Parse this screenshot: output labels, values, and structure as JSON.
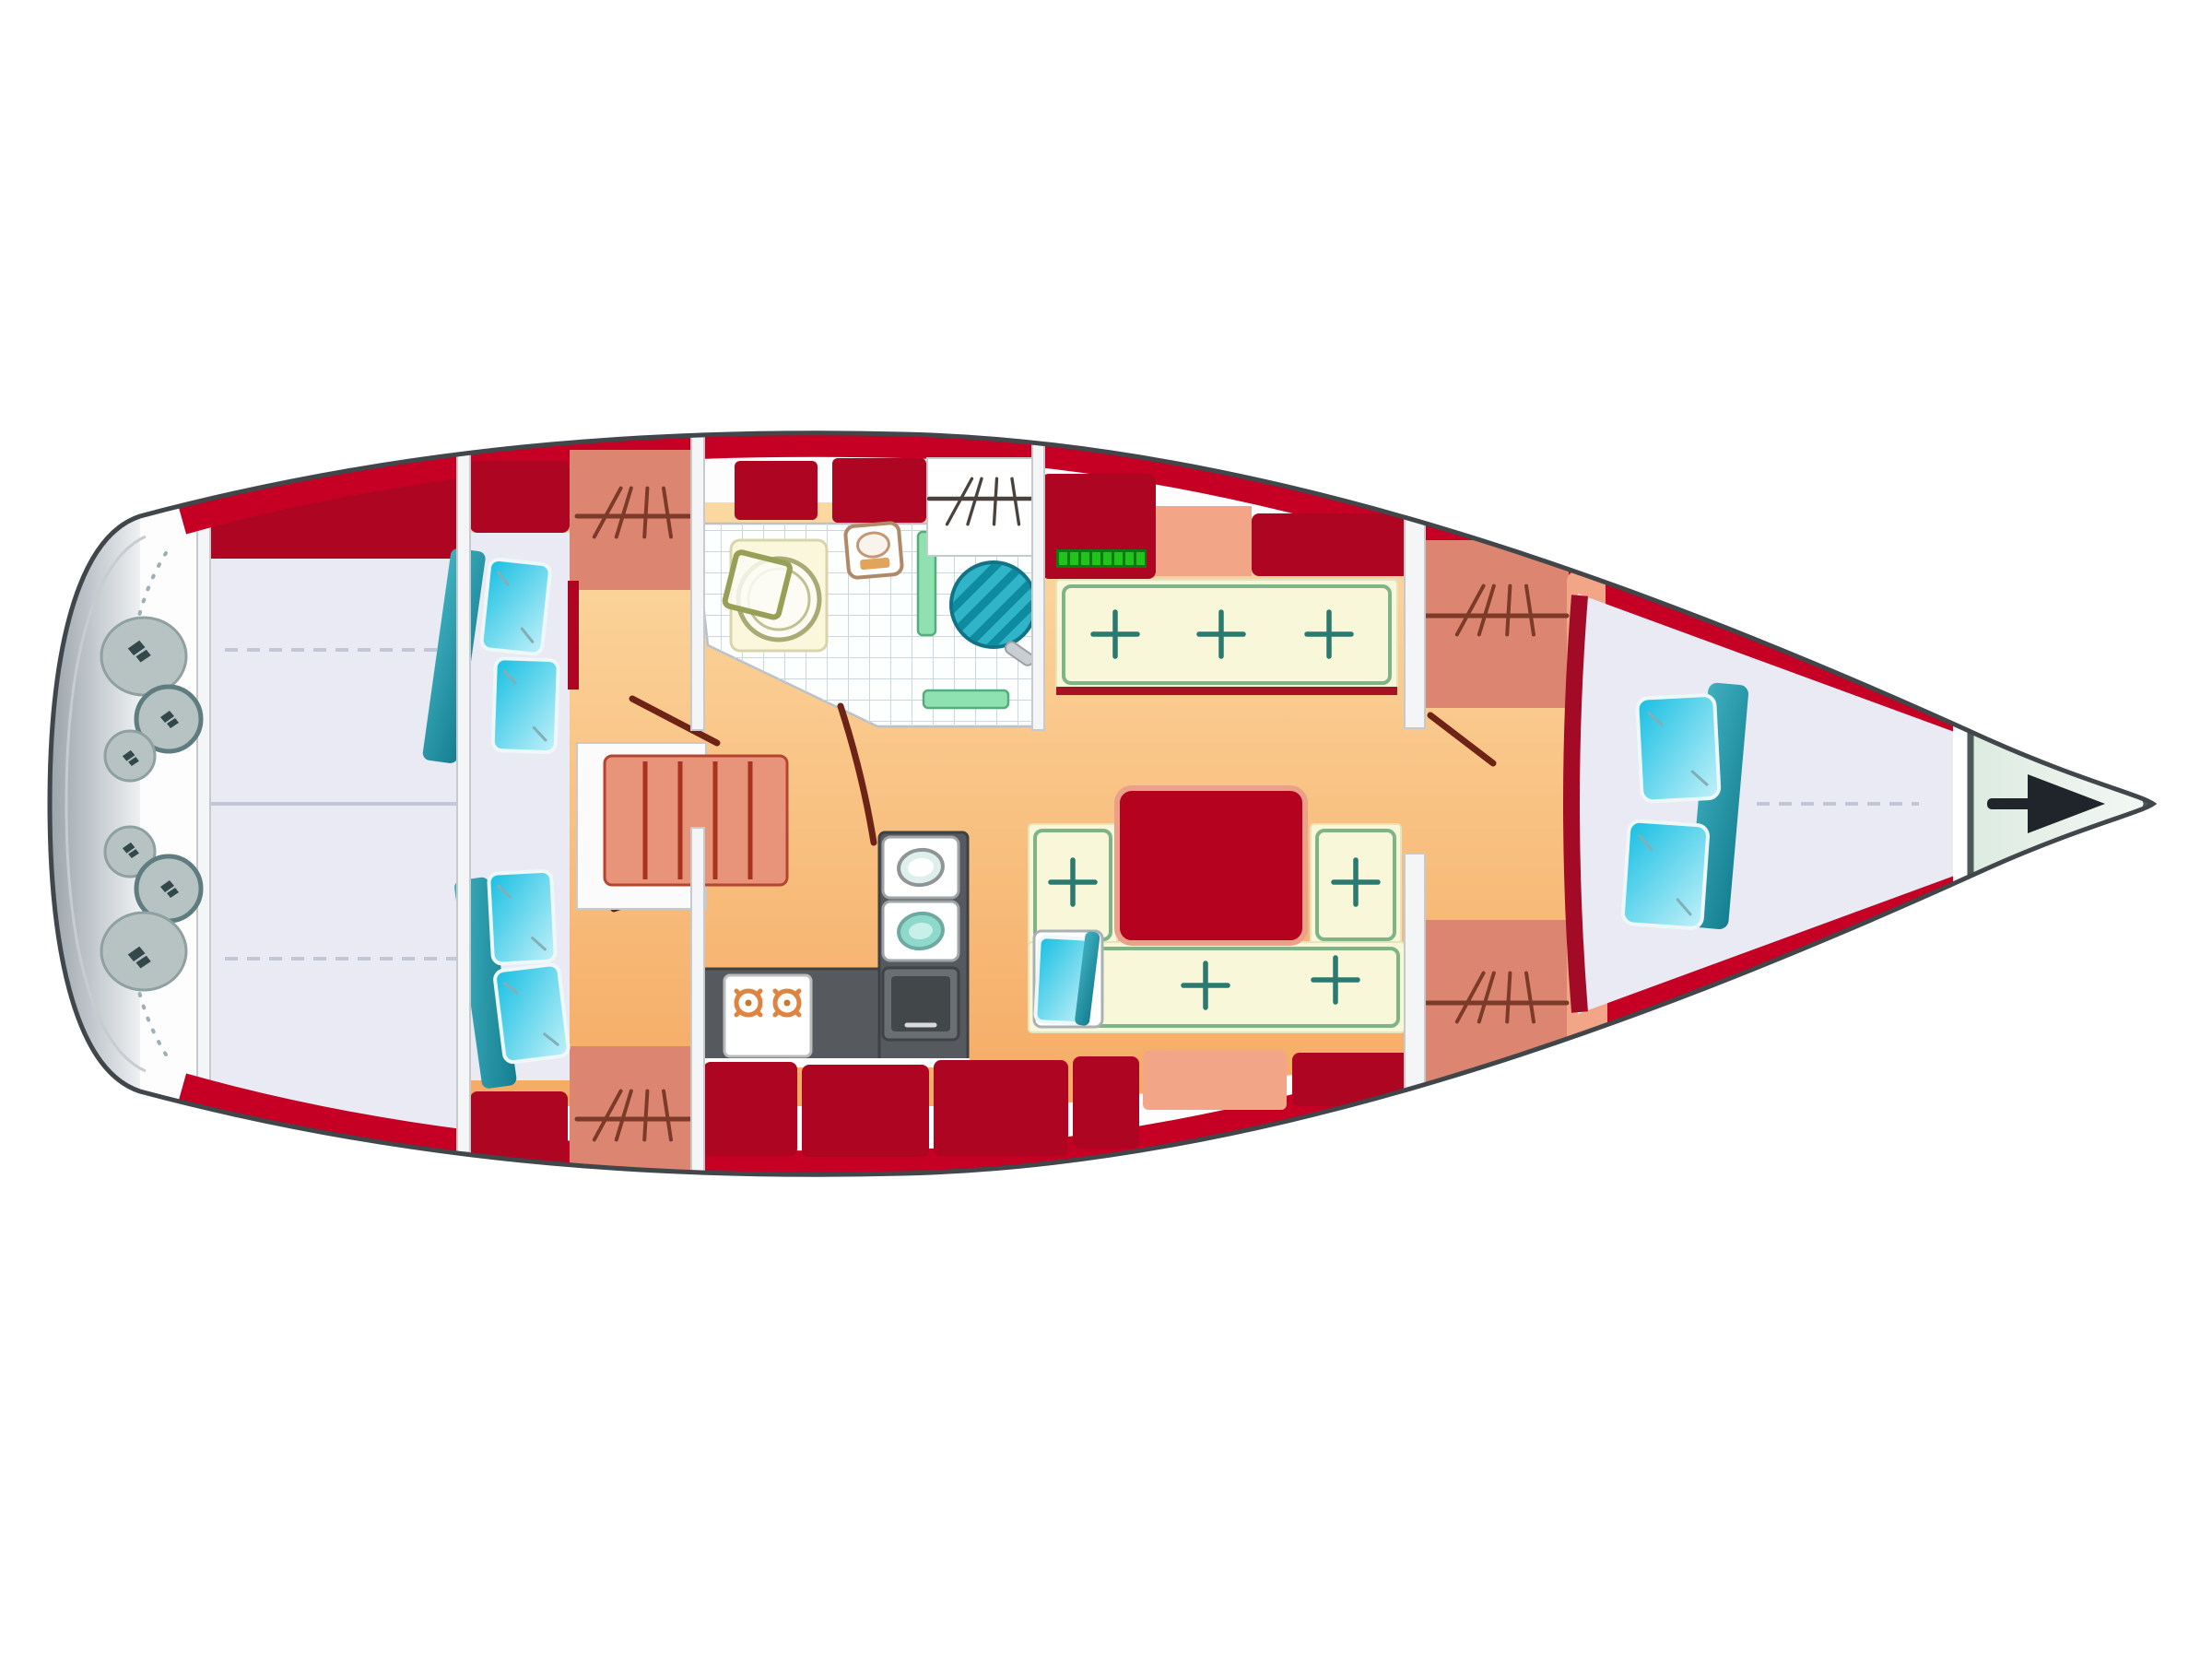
{
  "palette": {
    "hull_outline": "#40464a",
    "hull_fill": "#fdfdfe",
    "band_red": "#c50024",
    "block_red": "#ad0522",
    "table_red": "#b4021f",
    "table_edge": "#eba189",
    "berth_salmon": "#dc8671",
    "salmon_light": "#f2a687",
    "floor_light": "#fcd9a2",
    "floor_deep": "#f5ab64",
    "lavender": "#e9eaf4",
    "cream": "#f8f7d9",
    "cream_edge": "#e6e4bc",
    "settee_green": "#7fb489",
    "settee_lip": "#a51325",
    "tuft_teal": "#2a7a72",
    "cyan_light": "#c2f1f9",
    "cyan_deep": "#17bfe3",
    "blanket_teal": "#147e90",
    "blanket_teal_light": "#3fb0bf",
    "green_strip": "#8fe2b0",
    "green_strip_border": "#57ab7e",
    "bright_green": "#21c41d",
    "bright_green_dark": "#0b7a10",
    "galley_dark": "#565a5e",
    "galley_edge": "#3d4144",
    "burner_orange": "#df8440",
    "tile_line": "#ccd6de",
    "tile_fill": "#fdfefe",
    "platform_dark": "#9aa4ab",
    "platform_light": "#eef0f2",
    "winch_gray": "#b7c2c3",
    "winch_border": "#8fa0a1",
    "winch_ring": "#5f7d80",
    "winch_glyph": "#33484b",
    "anchor_dark": "#20252b",
    "bow_fill": "#dcebe1",
    "bow_fill_light": "#f3f8f4",
    "bow_outline": "#4b5a58",
    "door_line": "#6e2317",
    "hatch_line": "#7c3a28",
    "hatch_dark": "#4a423c",
    "wall_fill": "#f4f5f7",
    "wall_line": "#c6cacd",
    "shower_ring": "#a9aa74",
    "shower_panel": "#faf7dc",
    "shower_panel_edge": "#d9d5ab",
    "toilet_line": "#b08968",
    "toilet_seat": "#e2a35b",
    "basin_teal": "#2fb4c8",
    "basin_stripe": "#0f8ba0",
    "basin_edge": "#107486",
    "seam_line": "#c2c6d6",
    "white": "#ffffff",
    "steps_fill": "#e8947a",
    "steps_line": "#a83420",
    "steps_edge": "#b5452f"
  },
  "plan": {
    "type": "sailboat-interior-floor-plan",
    "orientation": {
      "bow": "right",
      "stern": "left"
    },
    "rooms": [
      {
        "name": "swim-platform",
        "fixtures": [
          "transom-rail"
        ]
      },
      {
        "name": "cockpit",
        "fixtures": [
          "steering-winches",
          "bench-seat",
          "centerline-seam"
        ],
        "winch_count": 6
      },
      {
        "name": "aft-cabin-port",
        "fixtures": [
          "double-berth",
          "pillows",
          "locker",
          "door"
        ],
        "pillow_count": 2
      },
      {
        "name": "aft-cabin-starboard",
        "fixtures": [
          "double-berth",
          "pillows",
          "locker",
          "door"
        ],
        "pillow_count": 2
      },
      {
        "name": "companionway",
        "fixtures": [
          "steps"
        ],
        "step_count": 5
      },
      {
        "name": "head",
        "fixtures": [
          "shower",
          "toilet",
          "washbasin",
          "tiled-floor",
          "counter-strips"
        ]
      },
      {
        "name": "galley",
        "fixtures": [
          "stove",
          "double-sink",
          "oven"
        ],
        "burner_count": 2,
        "sink_count": 2
      },
      {
        "name": "salon",
        "fixtures": [
          "port-settee",
          "u-shaped-dinette",
          "table",
          "cyan-seat"
        ],
        "tuft_marks": 7
      },
      {
        "name": "forward-cabin",
        "fixtures": [
          "v-berth",
          "pillows",
          "side-shelves",
          "door"
        ],
        "pillow_count": 2
      },
      {
        "name": "anchor-locker",
        "fixtures": [
          "anchor"
        ]
      }
    ]
  }
}
